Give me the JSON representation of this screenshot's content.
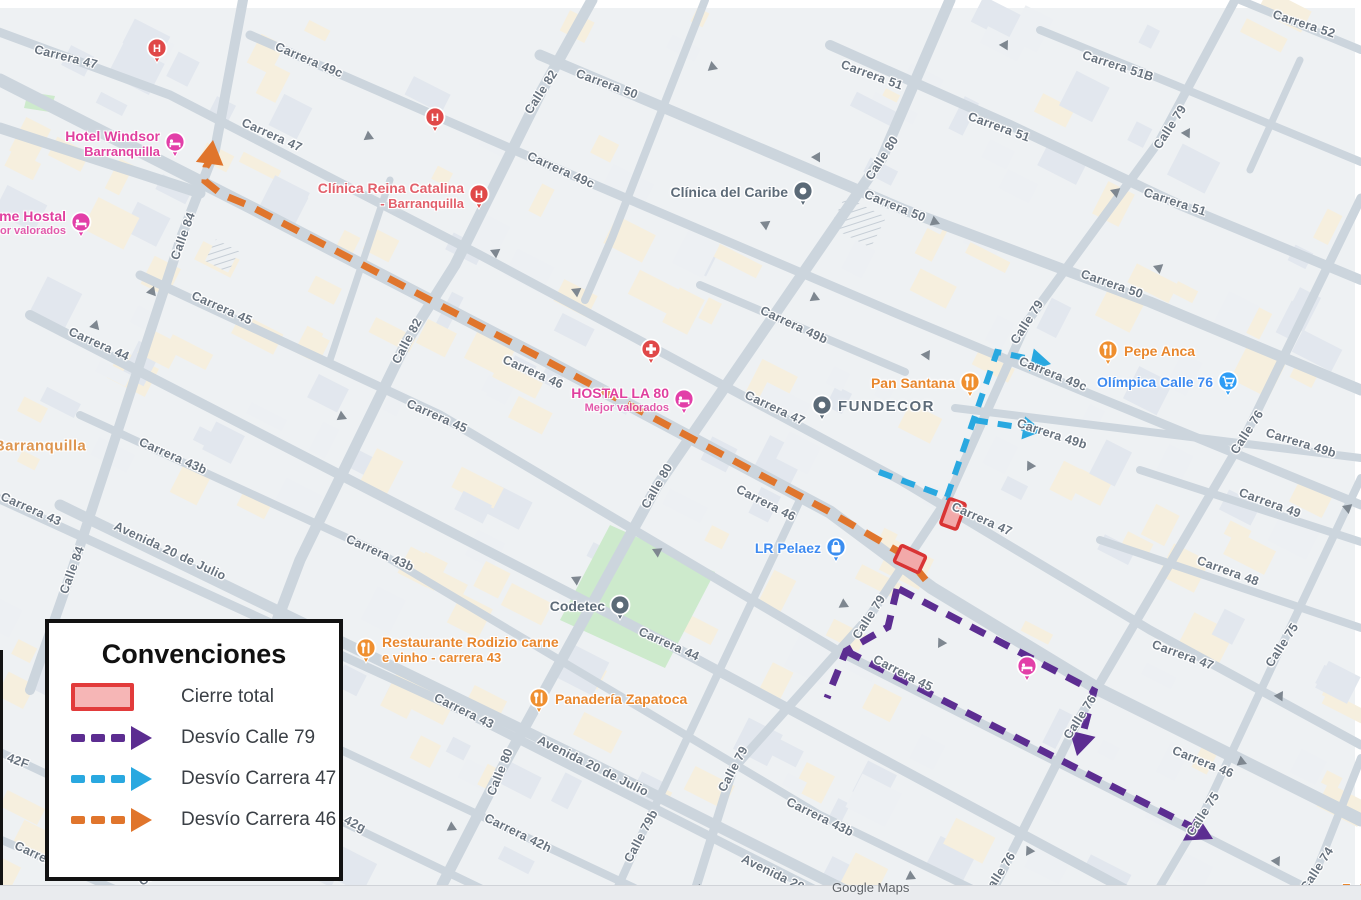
{
  "map_app": {
    "watermark": "Google Maps",
    "edge_label_right": "Est"
  },
  "legend": {
    "title": "Convenciones",
    "items": [
      {
        "label": "Cierre total",
        "type": "closure",
        "color": "#e23b3b",
        "fill": "#f6b6b6"
      },
      {
        "label": "Desvío Calle 79",
        "type": "dashed-arrow",
        "color": "#5c2d91"
      },
      {
        "label": "Desvío Carrera 47",
        "type": "dashed-arrow",
        "color": "#29a8e0"
      },
      {
        "label": "Desvío Carrera 46",
        "type": "dashed-arrow",
        "color": "#e0752c"
      }
    ]
  },
  "routes": {
    "closure_border": "#d93434",
    "closure_fill": "#f2a9a9",
    "desvio_calle_79": "#5c2d91",
    "desvio_carrera_47": "#29a8e0",
    "desvio_carrera_46": "#e0752c"
  },
  "streets": [
    {
      "t": "Carrera 47",
      "x": 66,
      "y": 57,
      "r": 14
    },
    {
      "t": "Carrera 49c",
      "x": 309,
      "y": 60,
      "r": 23
    },
    {
      "t": "Carrera 50",
      "x": 607,
      "y": 84,
      "r": 20
    },
    {
      "t": "Carrera 51",
      "x": 872,
      "y": 75,
      "r": 20
    },
    {
      "t": "Carrera 51B",
      "x": 1118,
      "y": 66,
      "r": 18
    },
    {
      "t": "Carrera 52",
      "x": 1304,
      "y": 24,
      "r": 18
    },
    {
      "t": "Carrera 47",
      "x": 272,
      "y": 135,
      "r": 24
    },
    {
      "t": "Carrera 49c",
      "x": 561,
      "y": 170,
      "r": 24
    },
    {
      "t": "Calle 82",
      "x": 541,
      "y": 92,
      "r": -57
    },
    {
      "t": "Calle 80",
      "x": 882,
      "y": 158,
      "r": -57
    },
    {
      "t": "Calle 79",
      "x": 1170,
      "y": 127,
      "r": -57
    },
    {
      "t": "Carrera 51",
      "x": 999,
      "y": 127,
      "r": 20
    },
    {
      "t": "Carrera 50",
      "x": 895,
      "y": 206,
      "r": 22
    },
    {
      "t": "Carrera 51",
      "x": 1175,
      "y": 202,
      "r": 18
    },
    {
      "t": "Carrera 50",
      "x": 1112,
      "y": 284,
      "r": 19
    },
    {
      "t": "Calle 84",
      "x": 183,
      "y": 236,
      "r": -70
    },
    {
      "t": "Carrera 45",
      "x": 222,
      "y": 308,
      "r": 24
    },
    {
      "t": "Carrera 44",
      "x": 99,
      "y": 344,
      "r": 24
    },
    {
      "t": "Calle 82",
      "x": 407,
      "y": 341,
      "r": -62
    },
    {
      "t": "Carrera 46",
      "x": 533,
      "y": 372,
      "r": 24
    },
    {
      "t": "Carrera 47",
      "x": 775,
      "y": 408,
      "r": 25
    },
    {
      "t": "Carrera 49b",
      "x": 794,
      "y": 325,
      "r": 25
    },
    {
      "t": "Carrera 49c",
      "x": 1053,
      "y": 374,
      "r": 22
    },
    {
      "t": "Carrera 49b",
      "x": 1052,
      "y": 434,
      "r": 18
    },
    {
      "t": "Calle 79",
      "x": 1027,
      "y": 322,
      "r": -57
    },
    {
      "t": "Carrera 43b",
      "x": 173,
      "y": 456,
      "r": 24
    },
    {
      "t": "Carrera 43",
      "x": 31,
      "y": 509,
      "r": 24
    },
    {
      "t": "Calle 84",
      "x": 72,
      "y": 570,
      "r": -70
    },
    {
      "t": "Avenida 20 de Julio",
      "x": 170,
      "y": 551,
      "r": 25
    },
    {
      "t": "Carrera 45",
      "x": 437,
      "y": 416,
      "r": 24
    },
    {
      "t": "Calle 80",
      "x": 657,
      "y": 486,
      "r": -60
    },
    {
      "t": "Carrera 46",
      "x": 766,
      "y": 503,
      "r": 27
    },
    {
      "t": "Calle 76",
      "x": 1247,
      "y": 432,
      "r": -57
    },
    {
      "t": "Carrera 49b",
      "x": 1301,
      "y": 443,
      "r": 17
    },
    {
      "t": "Carrera 49",
      "x": 1270,
      "y": 503,
      "r": 20
    },
    {
      "t": "Carrera 48",
      "x": 1228,
      "y": 571,
      "r": 20
    },
    {
      "t": "Carrera 43b",
      "x": 380,
      "y": 553,
      "r": 24
    },
    {
      "t": "Carrera 44",
      "x": 669,
      "y": 644,
      "r": 24
    },
    {
      "t": "Calle 79",
      "x": 869,
      "y": 617,
      "r": -57
    },
    {
      "t": "Carrera 45",
      "x": 903,
      "y": 673,
      "r": 27
    },
    {
      "t": "Carrera 47",
      "x": 982,
      "y": 519,
      "r": 24
    },
    {
      "t": "Carrera 47",
      "x": 1183,
      "y": 655,
      "r": 20
    },
    {
      "t": "Calle 75",
      "x": 1282,
      "y": 645,
      "r": -57
    },
    {
      "t": "Carrera 46",
      "x": 1203,
      "y": 762,
      "r": 22
    },
    {
      "t": "Calle 75",
      "x": 1203,
      "y": 814,
      "r": -57
    },
    {
      "t": "Calle 76",
      "x": 1080,
      "y": 717,
      "r": -57
    },
    {
      "t": "Carrera 43",
      "x": 464,
      "y": 711,
      "r": 26
    },
    {
      "t": "Calle 80",
      "x": 500,
      "y": 772,
      "r": -68
    },
    {
      "t": "Avenida 20 de Julio",
      "x": 593,
      "y": 766,
      "r": 26
    },
    {
      "t": "Calle 79b",
      "x": 641,
      "y": 836,
      "r": -62
    },
    {
      "t": "Calle 79",
      "x": 733,
      "y": 769,
      "r": -62
    },
    {
      "t": "Carrera 43b",
      "x": 820,
      "y": 817,
      "r": 26
    },
    {
      "t": "Avenida 20",
      "x": 773,
      "y": 873,
      "r": 26
    },
    {
      "t": "Carrera 42h",
      "x": 518,
      "y": 833,
      "r": 26
    },
    {
      "t": "42g",
      "x": 355,
      "y": 824,
      "r": 26
    },
    {
      "t": "Carrera 42e",
      "x": 48,
      "y": 860,
      "r": 25
    },
    {
      "t": "42F",
      "x": 18,
      "y": 761,
      "r": 20
    },
    {
      "t": "Calle 8",
      "x": 158,
      "y": 872,
      "r": -30
    },
    {
      "t": "Calle 76",
      "x": 999,
      "y": 874,
      "r": -57
    },
    {
      "t": "Calle 74",
      "x": 1317,
      "y": 869,
      "r": -57
    },
    {
      "t": "Barranquilla",
      "x": 40,
      "y": 446,
      "r": 0,
      "k": "city"
    }
  ],
  "pois": [
    {
      "icon": "hospital",
      "x": 157,
      "y": 50
    },
    {
      "icon": "hospital",
      "x": 435,
      "y": 119
    },
    {
      "icon": "hospital",
      "x": 479,
      "y": 196,
      "label": "Clínica Reina Catalina",
      "sub": "- Barranquilla",
      "cls": "medical",
      "side": "left"
    },
    {
      "icon": "medical",
      "x": 651,
      "y": 351
    },
    {
      "icon": "hotel",
      "x": 175,
      "y": 144,
      "label": "Hotel Windsor",
      "sub": "Barranquilla",
      "cls": "pink",
      "side": "left"
    },
    {
      "icon": "hotel",
      "x": 81,
      "y": 224,
      "label": "me Hostal",
      "sub": "or valorados",
      "cls": "pink",
      "side": "left",
      "subsmall": true
    },
    {
      "icon": "hotel",
      "x": 684,
      "y": 401,
      "label": "HOSTAL LA 80",
      "sub": "Mejor valorados",
      "cls": "pink",
      "side": "left",
      "subsmall": true
    },
    {
      "icon": "place",
      "x": 803,
      "y": 193,
      "label": "Clínica del Caribe",
      "cls": "gray",
      "side": "left"
    },
    {
      "icon": "place",
      "x": 822,
      "y": 407,
      "label": "FUNDECOR",
      "cls": "gray caps",
      "side": "right"
    },
    {
      "icon": "place",
      "x": 620,
      "y": 607,
      "label": "Codetec",
      "cls": "gray",
      "side": "left"
    },
    {
      "icon": "shopping",
      "x": 836,
      "y": 549,
      "label": "LR Pelaez",
      "cls": "blue",
      "side": "left"
    },
    {
      "icon": "cart",
      "x": 1228,
      "y": 383,
      "label": "Olímpica Calle 76",
      "cls": "blue",
      "side": "left"
    },
    {
      "icon": "restaurant",
      "x": 1108,
      "y": 352,
      "label": "Pepe Anca",
      "cls": "orange",
      "side": "right"
    },
    {
      "icon": "restaurant",
      "x": 970,
      "y": 384,
      "label": "Pan Santana",
      "cls": "orange",
      "side": "left"
    },
    {
      "icon": "restaurant",
      "x": 366,
      "y": 650,
      "label": "Restaurante Rodizio carne",
      "sub": "e vinho - carrera 43",
      "cls": "orange",
      "side": "right"
    },
    {
      "icon": "restaurant",
      "x": 539,
      "y": 700,
      "label": "Panadería Zapatoca",
      "cls": "orange",
      "side": "right"
    },
    {
      "icon": "hotel",
      "x": 1027,
      "y": 668
    }
  ]
}
